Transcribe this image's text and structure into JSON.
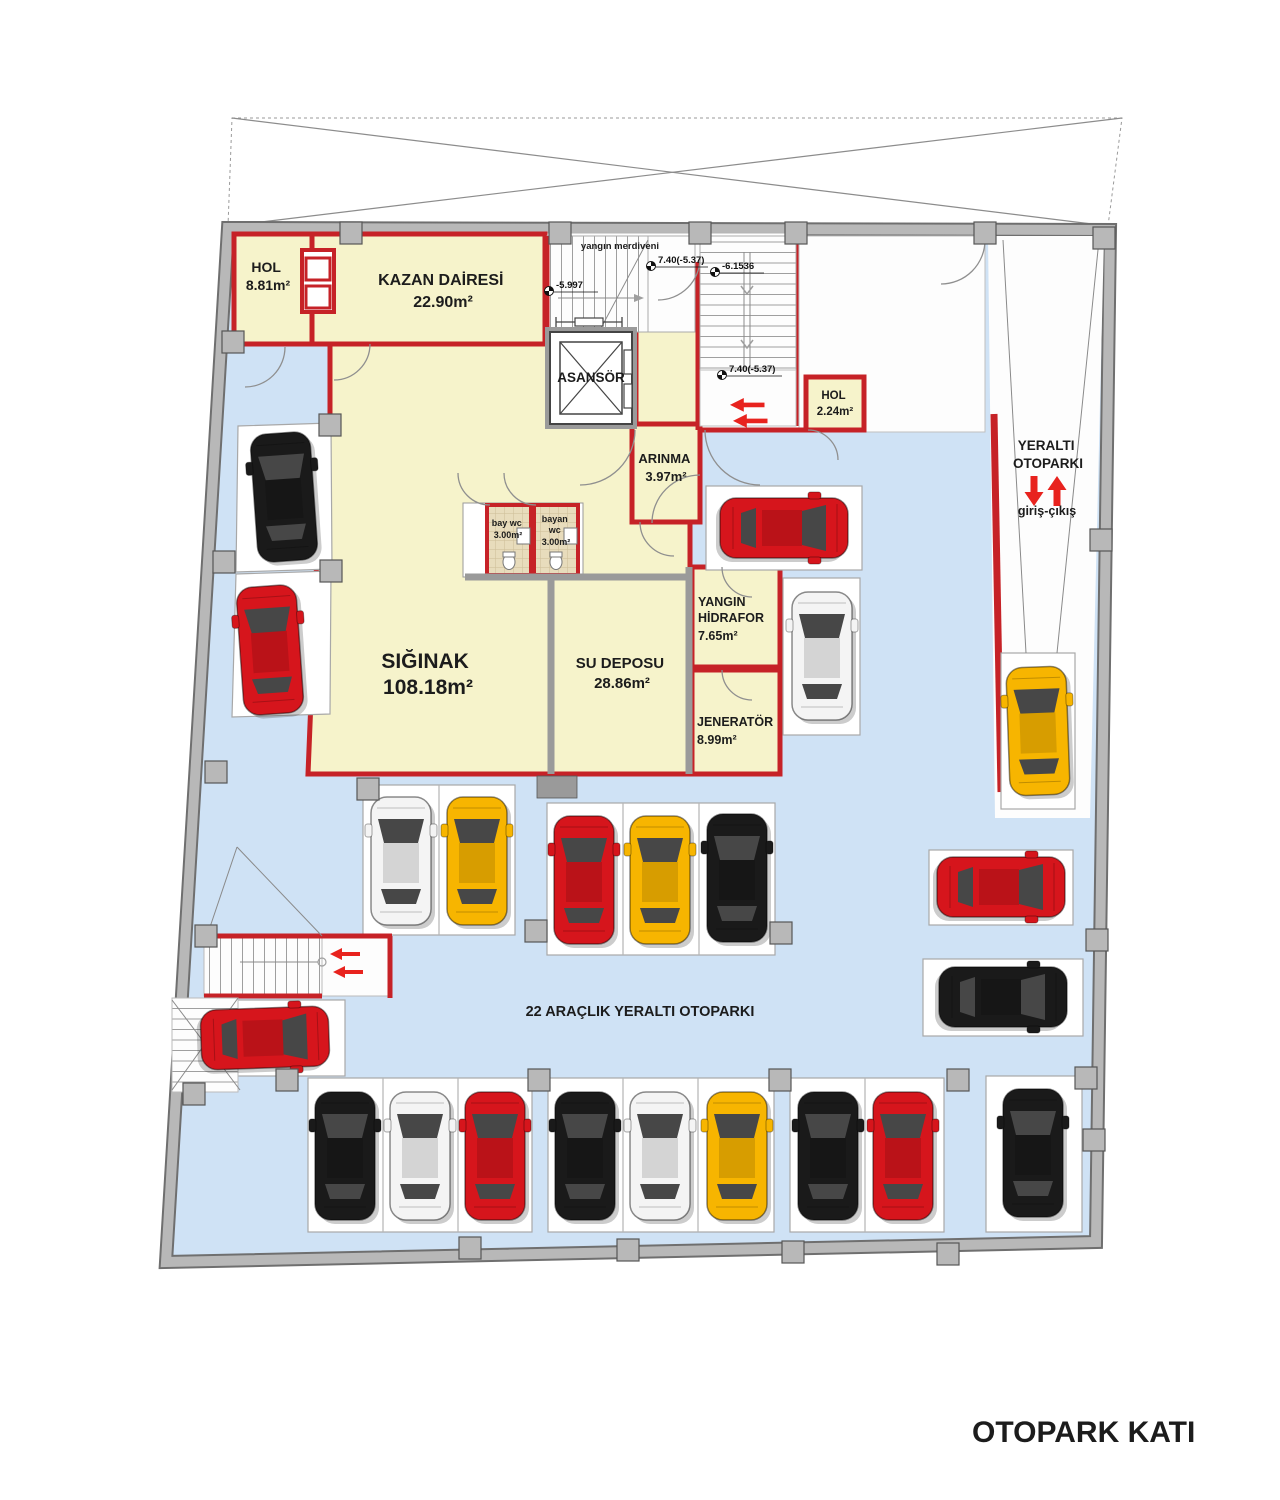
{
  "title": "OTOPARK KATI",
  "rooms": {
    "hol_tl": {
      "lines": [
        "HOL",
        "8.81m²"
      ]
    },
    "kazan": {
      "lines": [
        "KAZAN DAİRESİ",
        "22.90m²"
      ]
    },
    "asansor": {
      "lines": [
        "ASANSÖR"
      ]
    },
    "arinma": {
      "lines": [
        "ARINMA",
        "3.97m²"
      ]
    },
    "bay_wc": {
      "lines": [
        "bay wc",
        "3.00m²"
      ]
    },
    "bayan_wc": {
      "lines": [
        "bayan",
        "wc",
        "3.00m²"
      ]
    },
    "hol_tr": {
      "lines": [
        "HOL",
        "2.24m²"
      ]
    },
    "siginak": {
      "lines": [
        "SIĞINAK",
        "108.18m²"
      ]
    },
    "su_deposu": {
      "lines": [
        "SU DEPOSU",
        "28.86m²"
      ]
    },
    "yangin_hidrafor": {
      "lines": [
        "YANGIN",
        "HİDRAFOR",
        "7.65m²"
      ]
    },
    "jenerator": {
      "lines": [
        "JENERATÖR",
        "8.99m²"
      ]
    }
  },
  "annotations": {
    "fire_stairs": "yangın merdiveni",
    "ramp_line1": "YERALTI",
    "ramp_line2": "OTOPARKI",
    "ramp_sub": "giriş-çıkış",
    "parking_note": "22 ARAÇLIK YERALTI OTOPARKI",
    "levels": {
      "l1": "-5.997",
      "l2": "7.40(-5.37)",
      "l3": "-6.1536",
      "l4": "7.40(-5.37)"
    }
  },
  "colors": {
    "floor_blue": "#cfe2f5",
    "room_yellow": "#f6f3cb",
    "wall_red": "#c62227",
    "wall_gray": "#b8b8b8",
    "arrow_red": "#e8231e",
    "wc_tile": "#e8dcbc"
  },
  "car_colors": {
    "red": "#d6151c",
    "black": "#1a1a1a",
    "white": "#f4f4f4",
    "yellow": "#f7b500"
  },
  "cars": [
    {
      "x": 284,
      "y": 497,
      "r": -4,
      "c": "black"
    },
    {
      "x": 270,
      "y": 650,
      "r": -4,
      "c": "red"
    },
    {
      "x": 265,
      "y": 1038,
      "r": 88,
      "c": "red"
    },
    {
      "x": 784,
      "y": 528,
      "r": 90,
      "c": "red"
    },
    {
      "x": 822,
      "y": 656,
      "r": 0,
      "c": "white"
    },
    {
      "x": 1038,
      "y": 731,
      "r": -2,
      "c": "yellow"
    },
    {
      "x": 1001,
      "y": 887,
      "r": 90,
      "c": "red"
    },
    {
      "x": 1003,
      "y": 997,
      "r": 90,
      "c": "black"
    },
    {
      "x": 401,
      "y": 861,
      "r": 0,
      "c": "white"
    },
    {
      "x": 477,
      "y": 861,
      "r": 0,
      "c": "yellow"
    },
    {
      "x": 584,
      "y": 880,
      "r": 0,
      "c": "red"
    },
    {
      "x": 660,
      "y": 880,
      "r": 0,
      "c": "yellow"
    },
    {
      "x": 737,
      "y": 878,
      "r": 0,
      "c": "black"
    },
    {
      "x": 345,
      "y": 1156,
      "r": 0,
      "c": "black"
    },
    {
      "x": 420,
      "y": 1156,
      "r": 0,
      "c": "white"
    },
    {
      "x": 495,
      "y": 1156,
      "r": 0,
      "c": "red"
    },
    {
      "x": 585,
      "y": 1156,
      "r": 0,
      "c": "black"
    },
    {
      "x": 660,
      "y": 1156,
      "r": 0,
      "c": "white"
    },
    {
      "x": 737,
      "y": 1156,
      "r": 0,
      "c": "yellow"
    },
    {
      "x": 828,
      "y": 1156,
      "r": 0,
      "c": "black"
    },
    {
      "x": 903,
      "y": 1156,
      "r": 0,
      "c": "red"
    },
    {
      "x": 1033,
      "y": 1153,
      "r": 0,
      "c": "black"
    }
  ]
}
